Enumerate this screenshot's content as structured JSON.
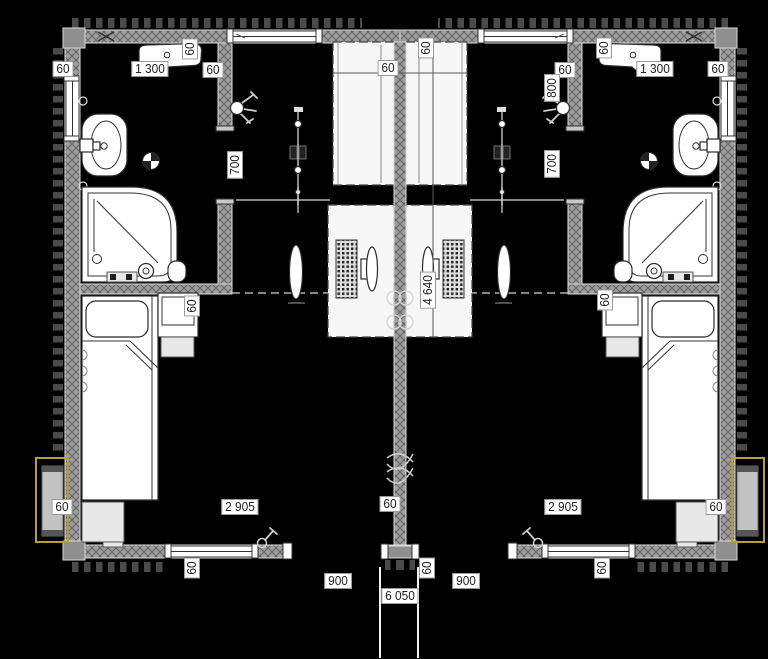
{
  "drawing": {
    "kind": "architectural floor plan, twin mirrored units",
    "canvas": {
      "width": 768,
      "height": 659
    }
  },
  "colors": {
    "bg": "#000000",
    "wall_edge": "#dcdcdc",
    "accent": "#b3a233",
    "label_bg": "#ffffff",
    "label_text": "#1f1f1f"
  },
  "dimension_labels": [
    {
      "text": "60",
      "x": 63,
      "y": 69,
      "rot": 0
    },
    {
      "text": "1 300",
      "x": 150,
      "y": 69,
      "rot": 0
    },
    {
      "text": "60",
      "x": 190,
      "y": 49,
      "rot": 1
    },
    {
      "text": "60",
      "x": 213,
      "y": 70,
      "rot": 0
    },
    {
      "text": "60",
      "x": 388,
      "y": 68,
      "rot": 0
    },
    {
      "text": "60",
      "x": 426,
      "y": 48,
      "rot": 1
    },
    {
      "text": "700",
      "x": 235,
      "y": 165,
      "rot": 1
    },
    {
      "text": "60",
      "x": 604,
      "y": 48,
      "rot": 1
    },
    {
      "text": "1 300",
      "x": 655,
      "y": 69,
      "rot": 0
    },
    {
      "text": "60",
      "x": 718,
      "y": 69,
      "rot": 0
    },
    {
      "text": "60",
      "x": 565,
      "y": 70,
      "rot": 0
    },
    {
      "text": "800",
      "x": 552,
      "y": 88,
      "rot": 1
    },
    {
      "text": "700",
      "x": 552,
      "y": 164,
      "rot": 1
    },
    {
      "text": "60",
      "x": 192,
      "y": 306,
      "rot": 1
    },
    {
      "text": "60",
      "x": 605,
      "y": 300,
      "rot": 1
    },
    {
      "text": "4 640",
      "x": 428,
      "y": 290,
      "rot": 1
    },
    {
      "text": "60",
      "x": 62,
      "y": 507,
      "rot": 0
    },
    {
      "text": "60",
      "x": 716,
      "y": 507,
      "rot": 0
    },
    {
      "text": "2 905",
      "x": 240,
      "y": 507,
      "rot": 0
    },
    {
      "text": "2 905",
      "x": 563,
      "y": 507,
      "rot": 0
    },
    {
      "text": "60",
      "x": 390,
      "y": 504,
      "rot": 0
    },
    {
      "text": "60",
      "x": 192,
      "y": 568,
      "rot": 1
    },
    {
      "text": "60",
      "x": 602,
      "y": 568,
      "rot": 1
    },
    {
      "text": "60",
      "x": 427,
      "y": 568,
      "rot": 1
    },
    {
      "text": "900",
      "x": 338,
      "y": 581,
      "rot": 0
    },
    {
      "text": "900",
      "x": 466,
      "y": 581,
      "rot": 0
    },
    {
      "text": "6 050",
      "x": 400,
      "y": 596,
      "rot": 0
    }
  ]
}
